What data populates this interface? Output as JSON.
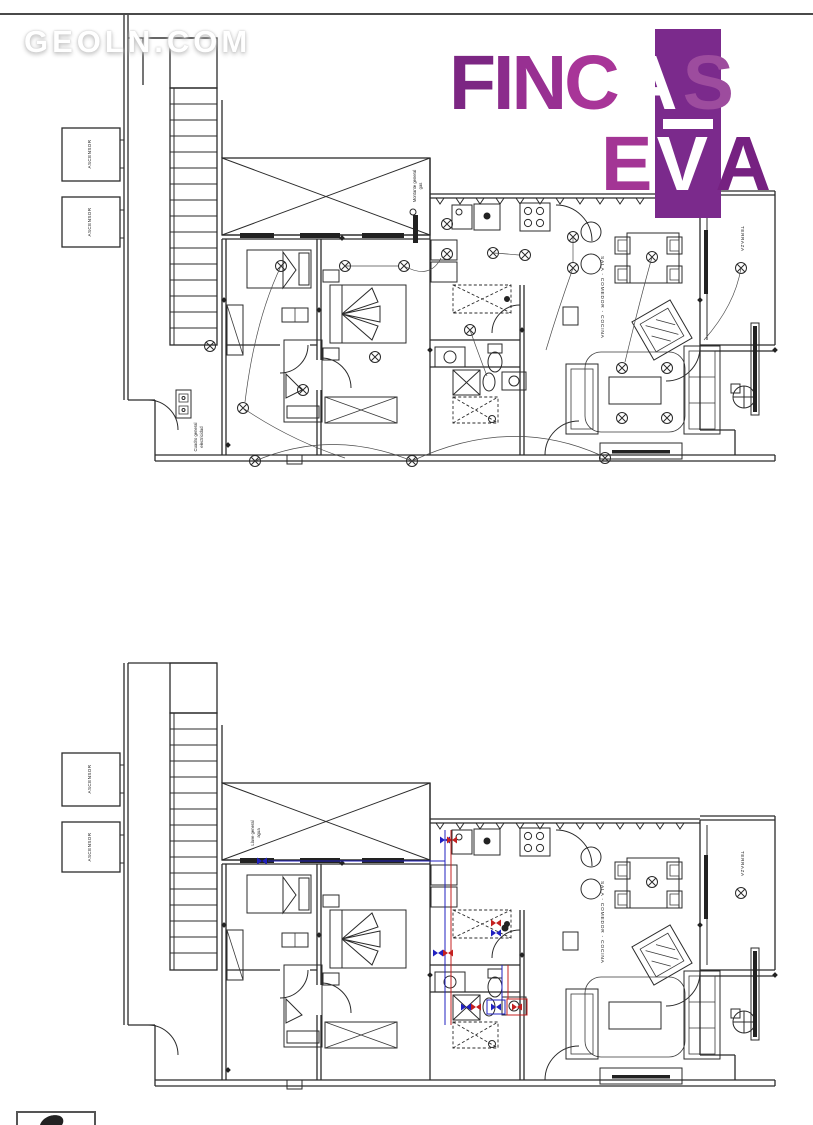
{
  "watermark": {
    "text": "GEOLN.COM"
  },
  "logo": {
    "letters": {
      "f": "F",
      "i": "I",
      "n": "N",
      "c": "C",
      "a_boxed": "A",
      "s": "S",
      "e": "E",
      "v_boxed": "V",
      "a_end": "A"
    },
    "colors": {
      "box_purple": "#7b2a8c",
      "f": "#7c2683",
      "i": "#8b2c8c",
      "n": "#983092",
      "c": "#a83598",
      "s": "#9d4c9e",
      "e": "#a33595",
      "a_end": "#762181",
      "boxed_letters": "#ffffff"
    }
  },
  "plan_shared": {
    "elevator_label": "ASCENSOR",
    "living_label": "SALA - COMEDOR - COCINA",
    "terrace_label": "TERRAZA"
  },
  "plan_top": {
    "gas_label_line1": "Montante general",
    "gas_label_line2": "gas",
    "panel_label_line1": "Cuadro general",
    "panel_label_line2": "electricidad"
  },
  "plan_bottom": {
    "water_label_line1": "Llave general",
    "water_label_line2": "agua"
  },
  "colors": {
    "line": "#2b2b2b",
    "wire": "#4a4a4a",
    "cold_water": "#2020c0",
    "hot_water": "#c42020"
  }
}
